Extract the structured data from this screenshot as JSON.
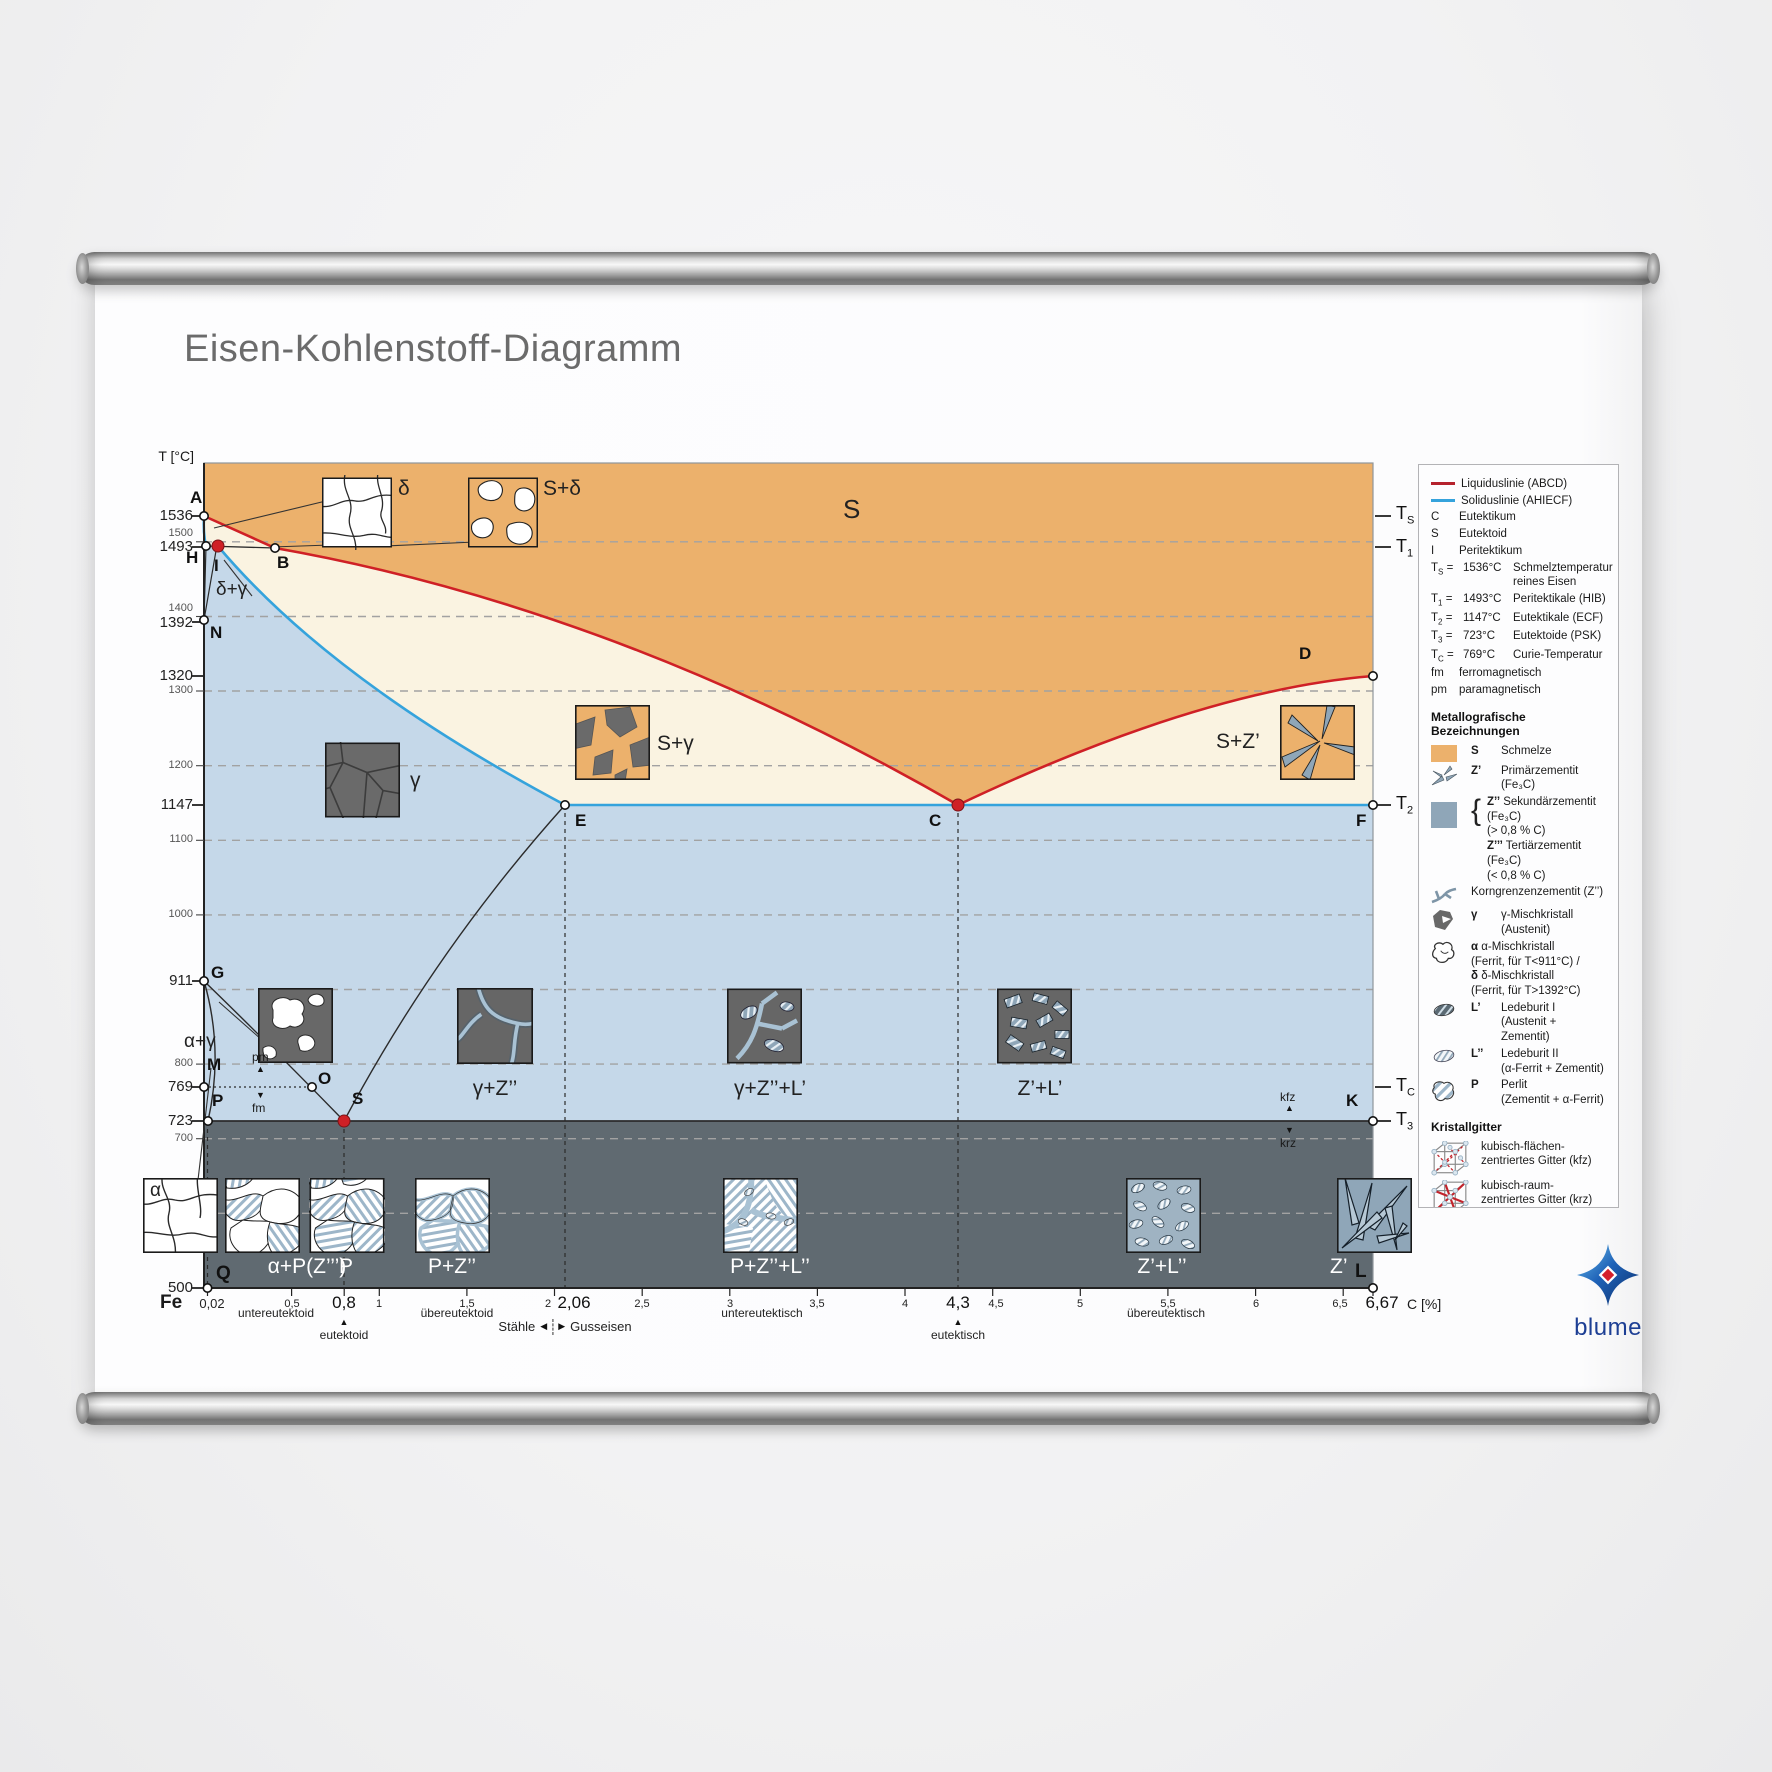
{
  "poster": {
    "title": "Eisen-Kohlenstoff-Diagramm"
  },
  "brand": {
    "name": "blume"
  },
  "axis": {
    "y_title": "T [°C]",
    "x_unit": "C [%]",
    "fe": "Fe",
    "y_major": {
      "t1536": "1536",
      "t1493": "1493",
      "t1392": "1392",
      "t1320": "1320",
      "t1147": "1147",
      "t911": "911",
      "t769": "769",
      "t723": "723",
      "t500": "500"
    },
    "y_minor": {
      "t1500": "1500",
      "t1400": "1400",
      "t1300": "1300",
      "t1200": "1200",
      "t1100": "1100",
      "t1000": "1000",
      "t800": "800",
      "t700": "700"
    },
    "x_major": {
      "c002": "0,02",
      "c08": "0,8",
      "c206": "2,06",
      "c43": "4,3",
      "c667": "6,67"
    },
    "x_minor": {
      "c05": "0,5",
      "c1": "1",
      "c15": "1,5",
      "c2": "2",
      "c25": "2,5",
      "c3": "3",
      "c35": "3,5",
      "c4": "4",
      "c45": "4,5",
      "c5": "5",
      "c55": "5,5",
      "c6": "6",
      "c65": "6,5"
    }
  },
  "right_axis": {
    "t": "T",
    "s": "S",
    "n1": "1",
    "n2": "2",
    "n3": "3",
    "c": "C"
  },
  "points": {
    "A": "A",
    "B": "B",
    "C": "C",
    "D": "D",
    "E": "E",
    "F": "F",
    "G": "G",
    "H": "H",
    "I": "I",
    "K": "K",
    "L": "L",
    "M": "M",
    "N": "N",
    "O": "O",
    "P": "P",
    "Q": "Q",
    "S": "S"
  },
  "regions": {
    "schmelze": "S",
    "delta": "δ",
    "s_delta": "S+δ",
    "gamma": "γ",
    "s_gamma": "S+γ",
    "s_z1": "S+Z’",
    "delta_gamma": "δ+γ",
    "alpha_gamma": "α+γ",
    "gamma_z2": "γ+Z’’",
    "gamma_z2_l1": "γ+Z’’+L’",
    "z1_l1": "Z’+L’",
    "alpha_p_z3": "α+P(Z’’’)",
    "p": "P",
    "p_z2": "P+Z’’",
    "p_z2_l2": "P+Z’’+L’’",
    "z1_l2": "Z’+L’’",
    "z1": "Z’",
    "alpha": "α"
  },
  "class_labels": {
    "untereutektoid": "untereutektoid",
    "eutektoid": "eutektoid",
    "uebereutektoid": "übereutektoid",
    "staehle": "Stähle",
    "gusseisen": "Gusseisen",
    "untereutektisch": "untereutektisch",
    "eutektisch": "eutektisch",
    "uebereutektisch": "übereutektisch"
  },
  "mag": {
    "pm": "pm",
    "fm": "fm",
    "kfz": "kfz",
    "krz": "krz"
  },
  "icons": {
    "up": "▲",
    "down": "▼",
    "left": "◀",
    "right": "▶",
    "brace": "{"
  },
  "legend": {
    "liquidus": "Liquiduslinie (ABCD)",
    "solidus": "Soliduslinie (AHIECF)",
    "eq": "=",
    "abbr": [
      {
        "k": "C",
        "v": "Eutektikum"
      },
      {
        "k": "S",
        "v": "Eutektoid"
      },
      {
        "k": "I",
        "v": "Peritektikum"
      }
    ],
    "temps": [
      {
        "sub": "S",
        "val": "1536°C",
        "d1": "Schmelztemperatur",
        "d2": "reines Eisen"
      },
      {
        "sub": "1",
        "val": "1493°C",
        "d1": "Peritektikale (HIB)",
        "d2": ""
      },
      {
        "sub": "2",
        "val": "1147°C",
        "d1": "Eutektikale (ECF)",
        "d2": ""
      },
      {
        "sub": "3",
        "val": "723°C",
        "d1": "Eutektoide (PSK)",
        "d2": ""
      },
      {
        "sub": "C",
        "val": "769°C",
        "d1": "Curie-Temperatur",
        "d2": ""
      }
    ],
    "mag": [
      {
        "k": "fm",
        "v": "ferromagnetisch"
      },
      {
        "k": "pm",
        "v": "paramagnetisch"
      }
    ],
    "met_heading": "Metallografische Bezeichnungen",
    "schmelze": {
      "k": "S",
      "v": "Schmelze"
    },
    "z1": {
      "k": "Z’",
      "v": "Primärzementit (Fe₃C)"
    },
    "z2": {
      "k": "Z’’",
      "v1": "Sekundärzementit (Fe₃C)",
      "v2": "(> 0,8 % C)"
    },
    "z3": {
      "k": "Z’’’",
      "v1": "Tertiärzementit (Fe₃C)",
      "v2": "(< 0,8 % C)"
    },
    "korn": "Korngrenzenzementit (Z’’)",
    "gamma": {
      "k": "γ",
      "v": "γ-Mischkristall (Austenit)"
    },
    "alpha": {
      "k": "α",
      "v1": "α-Mischkristall",
      "v2": "(Ferrit, für T<911°C) /"
    },
    "delta": {
      "k": "δ",
      "v1": "δ-Mischkristall",
      "v2": "(Ferrit, für T>1392°C)"
    },
    "l1": {
      "k": "L’",
      "v1": "Ledeburit I",
      "v2": "(Austenit + Zementit)"
    },
    "l2": {
      "k": "L’’",
      "v1": "Ledeburit II",
      "v2": "(α-Ferrit + Zementit)"
    },
    "perlit": {
      "k": "P",
      "v1": "Perlit",
      "v2": "(Zementit + α-Ferrit)"
    },
    "gitter_heading": "Kristallgitter",
    "kfz": {
      "v1": "kubisch-flächen-",
      "v2": "zentriertes Gitter (kfz)"
    },
    "krz": {
      "v1": "kubisch-raum-",
      "v2": "zentriertes Gitter (krz)"
    }
  },
  "colors": {
    "melt_orange": "#ecb16c",
    "mush_cream": "#faf3e1",
    "austenite_blue": "#c5d8e9",
    "ferrite_dark": "#606a71",
    "liquidus_red": "#cf2026",
    "solidus_blue": "#35a3dc",
    "steel_blue": "#8fa6b8",
    "brand_blue": "#1d3f94"
  }
}
